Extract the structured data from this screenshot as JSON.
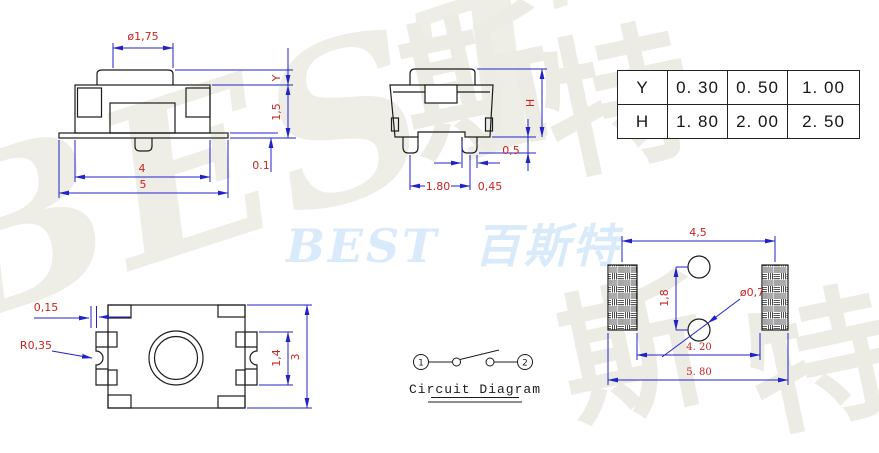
{
  "drawing": {
    "front_view": {
      "dia_label": "ø1,75",
      "y_label": "Y",
      "body_height_label": "1,5",
      "flange_label": "0.1",
      "inner_width_label": "4",
      "outer_width_label": "5"
    },
    "side_view": {
      "height_label": "H",
      "standoff_label": "0,5",
      "leg_pitch_label": "1.80",
      "leg_width_label": "0,45"
    },
    "top_view": {
      "gap_label": "0,15",
      "radius_label": "R0,35",
      "terminal_label": "1,4",
      "height_label": "3"
    },
    "pcb_view": {
      "pad_pitch_label": "4,5",
      "hole_pitch_label": "1,8",
      "hole_dia_label": "ø0,7",
      "inner_span_label": "4. 20",
      "outer_span_label": "5. 80"
    },
    "circuit": {
      "terminal1": "1",
      "terminal2": "2",
      "caption": "Circuit Diagram"
    }
  },
  "table": {
    "rows": [
      {
        "label": "Y",
        "values": [
          "0. 30",
          "0. 50",
          "1. 00"
        ]
      },
      {
        "label": "H",
        "values": [
          "1. 80",
          "2. 00",
          "2. 50"
        ]
      }
    ]
  },
  "watermarks": {
    "brand_blue": "BEST 百斯特",
    "brand_gray": "BEST",
    "char_top_1": "斯",
    "char_top_2": "特",
    "char_bottom_1": "斯",
    "char_bottom_2": "特"
  },
  "colors": {
    "dimension_text": "#cc2222",
    "dimension_line": "#2222cc",
    "outline": "#1c1c1c",
    "watermark_blue": "#d9ebfa",
    "watermark_gray": "#ecece4"
  }
}
